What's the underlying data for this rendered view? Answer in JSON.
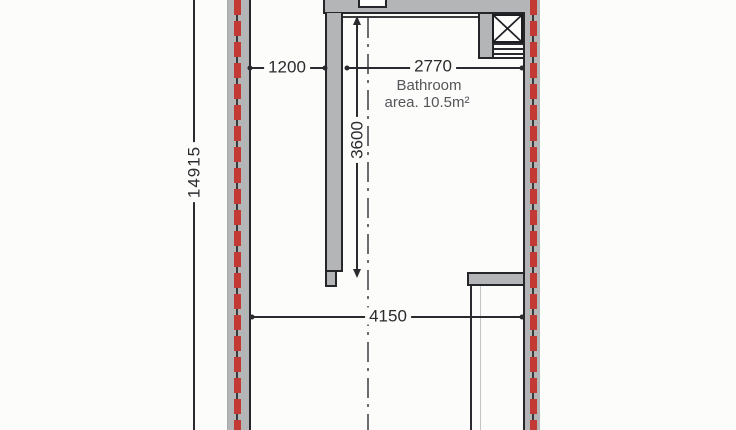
{
  "plan": {
    "type": "architectural-floor-plan",
    "room": {
      "name": "Bathroom",
      "area_label": "area.  10.5m²"
    },
    "dimensions": {
      "overall_length": "14915",
      "opening_width": "1200",
      "bathroom_width": "2770",
      "bathroom_depth": "3600",
      "room_width": "4150"
    },
    "symbols": {
      "shaft_icon": "crossed-box-ventilation-shaft",
      "wall_marker": "red-dashed-insulation-line",
      "axis_marker": "dash-dot-centerline"
    },
    "colors": {
      "wall_fill": "#b4b5b7",
      "outline": "#26262a",
      "marker_red": "#c23a33",
      "dimension": "#2b2b2f",
      "label_text": "#55565a",
      "background": "#fcfcfa"
    }
  }
}
